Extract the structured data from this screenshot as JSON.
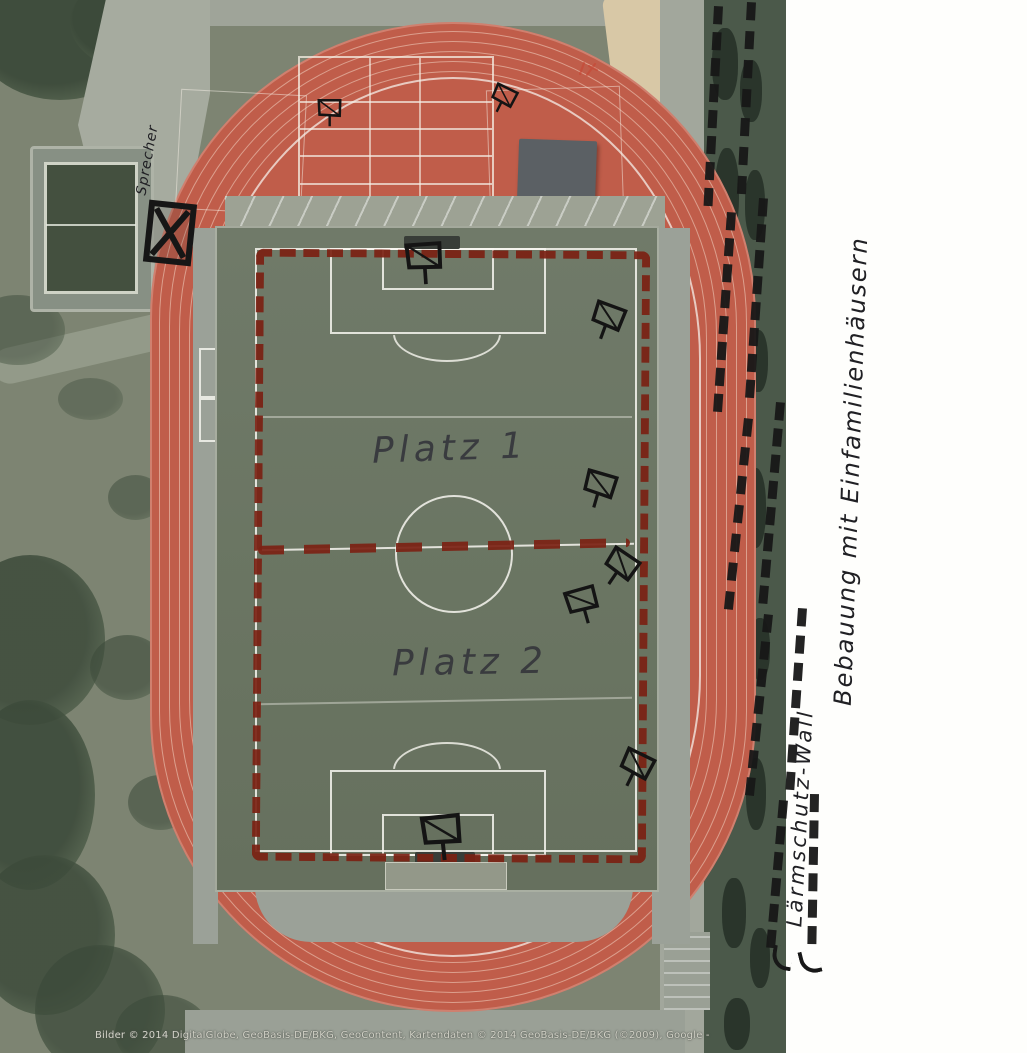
{
  "document": {
    "type": "scanned aerial photo of a sports stadium with handwritten planning annotations",
    "attribution": "Bilder © 2014 DigitalGlobe, GeoBasis-DE/BKG, GeoContent, Kartendaten © 2014 GeoBasis-DE/BKG (©2009), Google -"
  },
  "labels": {
    "platz1": "Platz 1",
    "platz2": "Platz 2",
    "sprecher": "Sprecher",
    "noise_wall": "Lärmschutz-Wall",
    "development": "Bebauung mit Einfamilienhäusern"
  },
  "colors": {
    "track": "#c05d4a",
    "turf": "#6a7562",
    "grass": "#7d8472",
    "hedge": "#4b594a",
    "concrete": "#9ba198",
    "red_annotation": "#7b2113",
    "ink": "#181818",
    "paper": "#fefefc",
    "sand": "#d8c8a6"
  },
  "overlay": {
    "floodlights": [
      {
        "x": 332,
        "y": 112,
        "r": -12,
        "s": 0.75
      },
      {
        "x": 505,
        "y": 100,
        "r": 14,
        "s": 0.75
      },
      {
        "x": 428,
        "y": 262,
        "r": -16,
        "s": 1.15
      },
      {
        "x": 610,
        "y": 322,
        "r": 8,
        "s": 1
      },
      {
        "x": 602,
        "y": 490,
        "r": 4,
        "s": 1
      },
      {
        "x": 622,
        "y": 570,
        "r": 22,
        "s": 1
      },
      {
        "x": 586,
        "y": 604,
        "r": -28,
        "s": 1
      },
      {
        "x": 638,
        "y": 770,
        "r": 14,
        "s": 1
      },
      {
        "x": 446,
        "y": 836,
        "r": -18,
        "s": 1.25
      }
    ],
    "ink_dash_segments": [
      {
        "x": 714,
        "y": 6,
        "h": 200,
        "r": 3
      },
      {
        "x": 727,
        "y": 212,
        "h": 200,
        "r": 4
      },
      {
        "x": 744,
        "y": 418,
        "h": 192,
        "r": 6
      },
      {
        "x": 764,
        "y": 614,
        "h": 182,
        "r": 6
      },
      {
        "x": 779,
        "y": 800,
        "h": 148,
        "r": 5
      },
      {
        "x": 747,
        "y": 2,
        "h": 192,
        "r": 3
      },
      {
        "x": 759,
        "y": 198,
        "h": 200,
        "r": 4
      },
      {
        "x": 776,
        "y": 402,
        "h": 202,
        "r": 5
      },
      {
        "x": 798,
        "y": 608,
        "h": 182,
        "r": 4
      },
      {
        "x": 810,
        "y": 794,
        "h": 150,
        "r": 1
      }
    ],
    "tree_blobs": [
      {
        "x": -25,
        "y": -30,
        "w": 170,
        "h": 130,
        "o": 0.95
      },
      {
        "x": 70,
        "y": -25,
        "w": 130,
        "h": 95,
        "o": 0.85
      },
      {
        "x": -30,
        "y": 295,
        "w": 95,
        "h": 70,
        "o": 0.5
      },
      {
        "x": -45,
        "y": 555,
        "w": 150,
        "h": 170,
        "o": 0.85
      },
      {
        "x": -35,
        "y": 700,
        "w": 130,
        "h": 190,
        "o": 0.9
      },
      {
        "x": -25,
        "y": 855,
        "w": 140,
        "h": 160,
        "o": 0.85
      },
      {
        "x": 35,
        "y": 945,
        "w": 130,
        "h": 130,
        "o": 0.75
      },
      {
        "x": 90,
        "y": 635,
        "w": 75,
        "h": 65,
        "o": 0.6
      },
      {
        "x": 108,
        "y": 475,
        "w": 55,
        "h": 45,
        "o": 0.5
      },
      {
        "x": 128,
        "y": 775,
        "w": 65,
        "h": 55,
        "o": 0.55
      },
      {
        "x": 58,
        "y": 378,
        "w": 65,
        "h": 42,
        "o": 0.4
      },
      {
        "x": 115,
        "y": 995,
        "w": 95,
        "h": 75,
        "o": 0.6
      }
    ],
    "hedge_blobs": [
      {
        "x": 712,
        "y": 28,
        "w": 26,
        "h": 72
      },
      {
        "x": 740,
        "y": 60,
        "w": 22,
        "h": 62
      },
      {
        "x": 715,
        "y": 148,
        "w": 24,
        "h": 92
      },
      {
        "x": 745,
        "y": 170,
        "w": 20,
        "h": 70
      },
      {
        "x": 718,
        "y": 298,
        "w": 26,
        "h": 82
      },
      {
        "x": 748,
        "y": 330,
        "w": 20,
        "h": 62
      },
      {
        "x": 714,
        "y": 430,
        "w": 24,
        "h": 72
      },
      {
        "x": 744,
        "y": 468,
        "w": 22,
        "h": 80
      },
      {
        "x": 720,
        "y": 578,
        "w": 26,
        "h": 72
      },
      {
        "x": 750,
        "y": 618,
        "w": 20,
        "h": 62
      },
      {
        "x": 716,
        "y": 718,
        "w": 26,
        "h": 90
      },
      {
        "x": 746,
        "y": 758,
        "w": 20,
        "h": 72
      },
      {
        "x": 722,
        "y": 878,
        "w": 24,
        "h": 70
      },
      {
        "x": 750,
        "y": 928,
        "w": 20,
        "h": 60
      },
      {
        "x": 724,
        "y": 998,
        "w": 26,
        "h": 52
      }
    ]
  }
}
